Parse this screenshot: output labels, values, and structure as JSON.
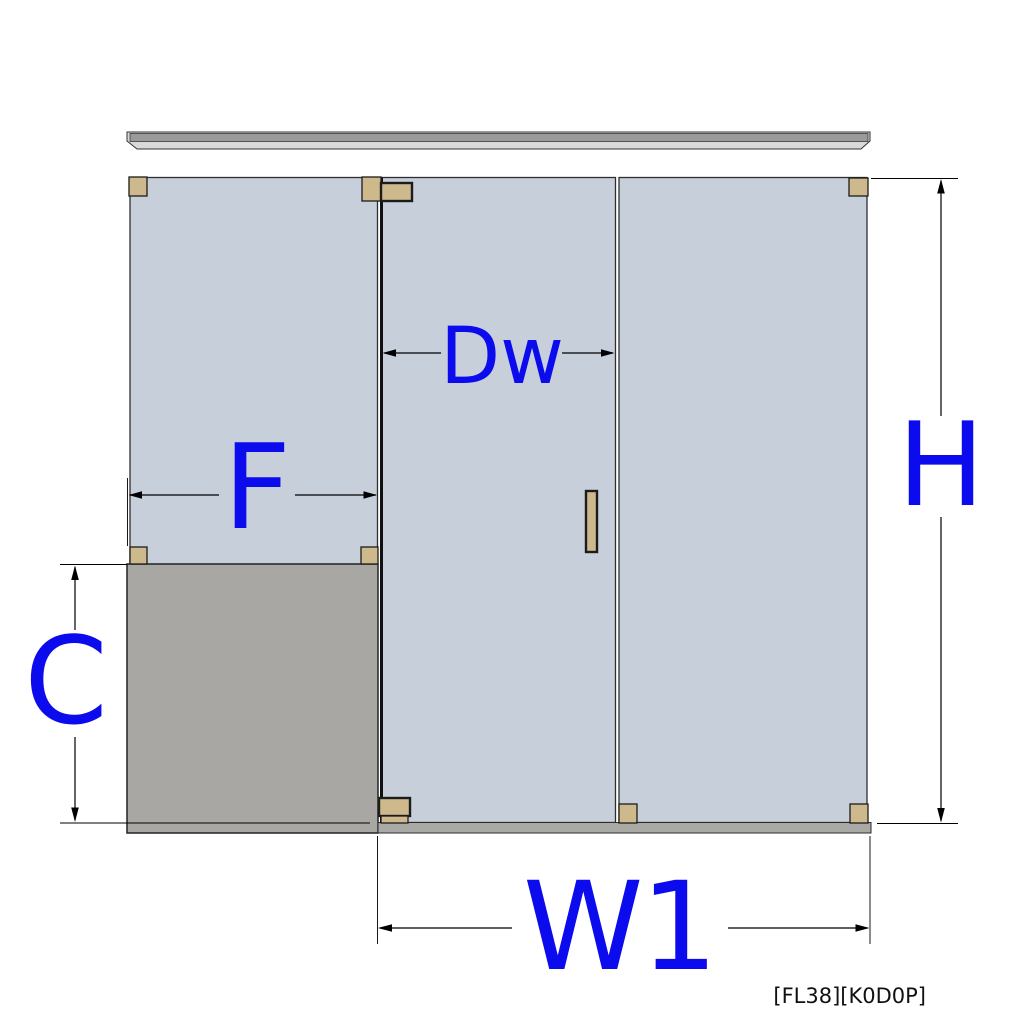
{
  "diagram": {
    "title": "shower-enclosure-elevation-drawing",
    "dimension_labels": {
      "door_width": "Dw",
      "left_fixed_panel_width": "F",
      "overall_height": "H",
      "buttress_height": "C",
      "width_1": "W1"
    },
    "footer_code": "[FL38][K0D0P]",
    "colors": {
      "label_blue": "#0b0bee",
      "glass": "#c6cfda",
      "hardware_tan": "#cdb98c",
      "curb_gray": "#a9a7a3",
      "sill_gray": "#a9a9a5",
      "track_gray": "#9a9a9a",
      "track_lip": "#d9d9d9",
      "line_black": "#000000"
    }
  }
}
